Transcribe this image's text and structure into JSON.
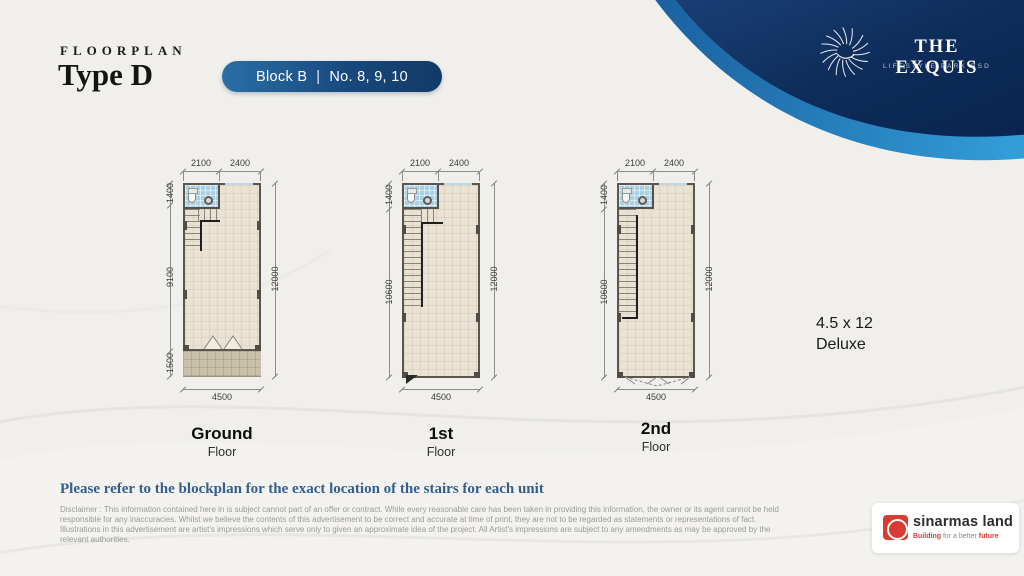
{
  "header": {
    "kicker": "FLOORPLAN",
    "title": "Type D",
    "badge": {
      "block": "Block B",
      "divider": "|",
      "units": "No. 8, 9, 10"
    }
  },
  "brand": {
    "name": "THE EXQUIS",
    "tagline": "LIFESTYLE PARK BSD"
  },
  "plans": [
    {
      "floor": "Ground",
      "floor_sub": "Floor",
      "dims": {
        "top_left": "2100",
        "top_right": "2400",
        "side_top": "1400",
        "side_mid": "9100",
        "side_bottom": "1500",
        "right": "12000",
        "bottom": "4500"
      }
    },
    {
      "floor": "1st",
      "floor_sub": "Floor",
      "dims": {
        "top_left": "2100",
        "top_right": "2400",
        "side_top": "1400",
        "side_mid": "10600",
        "right": "12000",
        "bottom": "4500"
      }
    },
    {
      "floor": "2nd",
      "floor_sub": "Floor",
      "dims": {
        "top_left": "2100",
        "top_right": "2400",
        "side_top": "1400",
        "side_mid": "10600",
        "right": "12000",
        "bottom": "4500"
      }
    }
  ],
  "legend": {
    "size": "4.5 x 12",
    "type": "Deluxe"
  },
  "note": "Please  refer to the blockplan for the exact location of the stairs for each unit",
  "disclaimer": {
    "lines": [
      "Disclaimer : This information contained here in is subject cannot part of an offer or contract. While every reasonable care has been taken in providing this information, the owner or its agent cannot be held",
      "responsible for any inaccuracies. Whilst we believe the contents of this advertisement to be correct and accurate at time of print, they are not to be regarded as statements or representations of fact.",
      "Illustrations in this advertisement are artist's impressions which serve only to given an approximate idea of the project. All Artist's impressions are subject to any amendments as may be approved by the",
      "relevant authorities."
    ]
  },
  "developer": {
    "name": "sinarmas land",
    "tag_bold1": "Building",
    "tag_mid": " for a better ",
    "tag_bold2": "future"
  },
  "colors": {
    "page_bg": "#f0efec",
    "navy": "#0d2a57",
    "blue_band": "#2e97d6",
    "badge_gradient_start": "#2a6ea6",
    "badge_gradient_end": "#123a68",
    "plan_floor": "#eae2d3",
    "carport": "#c9c1aa",
    "bathroom": "#a9d1e4",
    "note_text": "#33608f",
    "accent_bracket": "#1d3f77",
    "developer_red": "#d93a32"
  }
}
